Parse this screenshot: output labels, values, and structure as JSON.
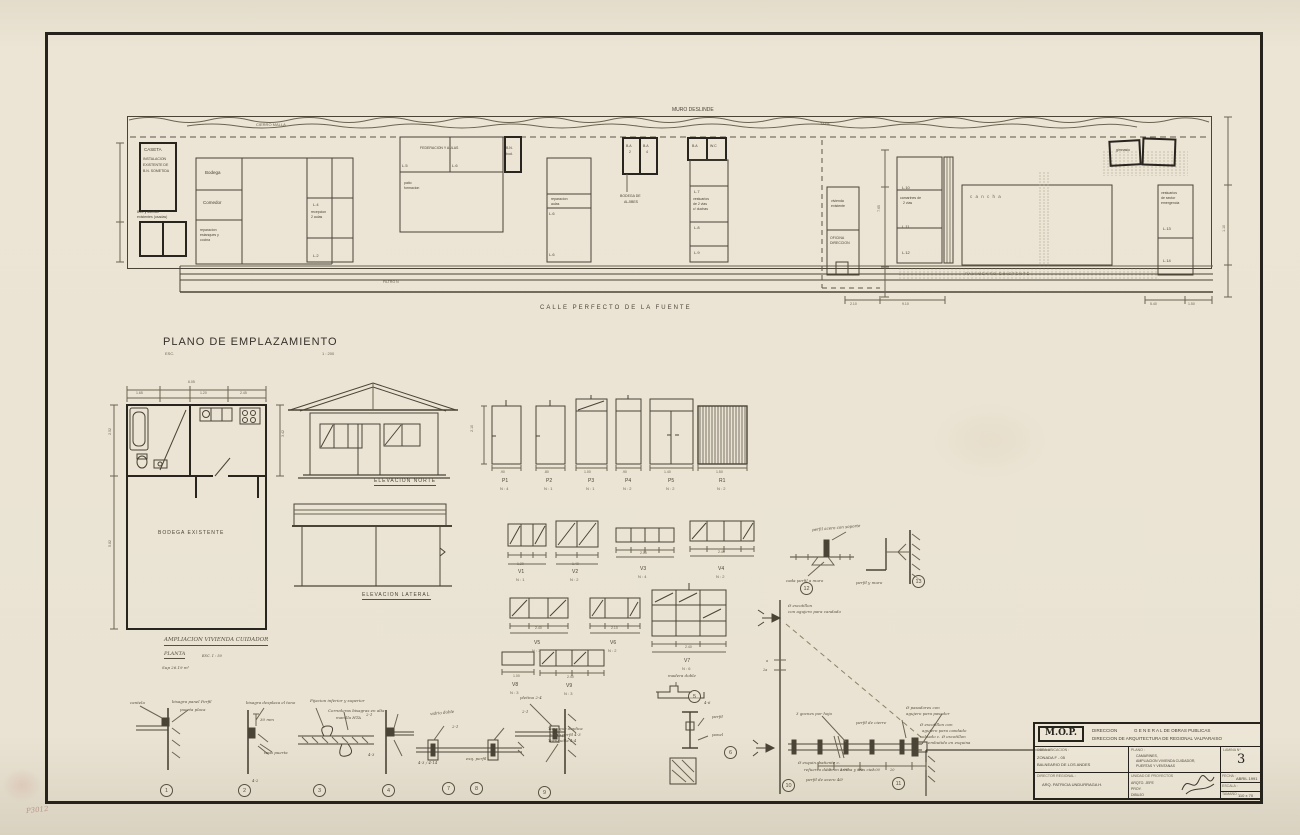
{
  "site": {
    "cierro": "CIERRO  MALLA",
    "muro": "MURO  DESLINDE",
    "tapa": "TAPA",
    "street": "CALLE   PERFECTO   DE   LA   FUENTE",
    "filtro": "FILTRO  N",
    "pavimento": "PAVIMENTO     EXISTENTE",
    "caseta_title": "CASETA",
    "caseta1": "INSTALACION",
    "caseta2": "EXISTENTE  DE",
    "caseta3": "B.N.  SOMETIDA",
    "ba1": "B.A. y duchas",
    "ba2": "existentes (usadas)",
    "bodega": "Bodega",
    "comedor": "Comedor",
    "repar1": "reparacion",
    "repar2": "estanques y",
    "repar3": "cocina",
    "recep1": "recepcion",
    "recep2": "2 aulas",
    "feder": "FEDERACION  Y  AULAS",
    "patio1": "patio",
    "patio2": "formacion",
    "bn1": "B.N.",
    "bn2": "bod.",
    "rep_aulas1": "reparacion",
    "rep_aulas2": "aulas",
    "baa1": "B.A",
    "baa2": "2",
    "bab1": "B.A",
    "bab2": "4",
    "aljibes1": "BODEGA  DE",
    "aljibes2": "ALJIBES",
    "bawc1": "B.A",
    "bawc2": "W.C",
    "vest1": "vestuarios",
    "vest2": "de 2 vias",
    "vest3": "c/ duchas",
    "viv1": "vivienda",
    "viv2": "existente",
    "ofic1": "OFICINA",
    "ofic2": "DIRECCION",
    "camar1": "camarines de",
    "camar2": "2 vias",
    "cancha": "c a n c h a",
    "gim": "gimnasio",
    "vestem1": "vestuarios",
    "vestem2": "de sector",
    "vestem3": "emergencia",
    "t2": "L.2",
    "t3": "L.3",
    "t4": "L.4",
    "t5": "L.5",
    "t6": "L.6",
    "t7": "L.7",
    "t8": "L.8",
    "t9": "L.9",
    "t10": "L.10",
    "t11": "L.11",
    "t12": "L.12",
    "t13": "L.13",
    "t14": "L.14",
    "d1": "2.10",
    "d2": "9.10",
    "d3": "5.40",
    "d4": "1.50",
    "d5": "7.65",
    "d6": "1.10"
  },
  "emplaza": {
    "title": "PLANO  DE  EMPLAZAMIENTO",
    "esc": "ESC.",
    "scale": "1 : 200"
  },
  "plan": {
    "room": "BODEGA    EXISTENTE",
    "cap1": "AMPLIACION  VIVIENDA  CUIDADOR",
    "cap2": "PLANTA",
    "cap2b": "ESC.   1 : 50",
    "cap3": "Sup   26.19  m²",
    "wtot": "6.05",
    "w1": "1.65",
    "w2": "1.20",
    "w3": "2.45",
    "h1": "2.52",
    "h2": "5.82",
    "h3": "3.42"
  },
  "elev": {
    "north": "ELEVACION   NORTE",
    "lateral": "ELEVACION   LATERAL"
  },
  "doors": {
    "height": "2.10",
    "items": [
      {
        "tag": "P1",
        "n": "N : 4",
        "w": ".90"
      },
      {
        "tag": "P2",
        "n": "N : 1",
        "w": ".80"
      },
      {
        "tag": "P3",
        "n": "N : 1",
        "w": "1.00"
      },
      {
        "tag": "P4",
        "n": "N : 2",
        "w": ".90"
      },
      {
        "tag": "P5",
        "n": "N : 2",
        "w": "1.40"
      },
      {
        "tag": "R1",
        "n": "N : 2",
        "w": "1.50"
      }
    ]
  },
  "windows": [
    {
      "tag": "V1",
      "n": "N : 1",
      "w": "1.20"
    },
    {
      "tag": "V2",
      "n": "N : 2",
      "w": "1.40"
    },
    {
      "tag": "V3",
      "n": "N : 4",
      "w": "2.00"
    },
    {
      "tag": "V4",
      "n": "N : 2",
      "w": "2.40"
    },
    {
      "tag": "V5",
      "n": "N : 3",
      "w": "2.40"
    },
    {
      "tag": "V6",
      "n": "N : 2",
      "w": "2.10"
    },
    {
      "tag": "V7",
      "n": "N : 6",
      "w": "2.40"
    },
    {
      "tag": "V8",
      "n": "N : 3",
      "w": "1.00"
    },
    {
      "tag": "V9",
      "n": "N : 3",
      "w": "2.40"
    }
  ],
  "det": {
    "c1": "1",
    "c2": "2",
    "c3": "3",
    "c4": "4",
    "c5": "5",
    "c6": "6",
    "c7": "7",
    "c8": "8",
    "c9": "9",
    "c10": "10",
    "c11": "11",
    "c12": "12",
    "c13": "13",
    "n1a": "cantela",
    "n1b": "bisagra panel  Perfil",
    "n1c": "puerta placa",
    "n2a": "bisagra desplaza el tono",
    "n2b": "30 mm",
    "n2c": "tapa puerta",
    "n2d": "4-2",
    "n3a": "Fijacion inferior y superior",
    "n3b": "Correderas bisagras en alta",
    "n3c": "manilla HTA",
    "n4a": "vidrio doble",
    "n4b": "2-1",
    "n4c": "4-3",
    "n78a": "2-1",
    "n78b": "esq. perfil",
    "n78c": "4-3 / 4-14",
    "n9a": "pletina 2-4",
    "n9b": "Tope que duplica",
    "n9c": "como perfil 4-3",
    "n9d": "Tornquilla 4-4",
    "n9e": "2-1",
    "n56a": "madera doble",
    "n56b": "4-6",
    "n56c": "perfil",
    "n56d": "panel",
    "n12a": "perfil acero con soporte",
    "n12b": "cada perfil a muro",
    "n13a": "perfil y muro",
    "g0a": "Ø escotillon",
    "g0b": "con agujero para candado",
    "g1": "3 goznes por hoja",
    "g2": "perfil de cierre",
    "g3a": "Ø pasadores con",
    "g3b": "agujero para  pasador",
    "g4a": "Ø escotillon con",
    "g4b": "agujero para candado",
    "g4c": "soldado c. Ø escotillon",
    "g4d": "embutido en esquina",
    "g5a": "Ø esquin. batiente c.",
    "g5b": "refuerzo de 8mm arriba y tras cier.",
    "g6": "perfil de acero 4Ø",
    "ga": "a",
    "gb": "2a",
    "gd1": "20",
    "gd2": "1.00",
    "gd3": "60",
    "gd4": "1.00",
    "gd5": "20"
  },
  "tb": {
    "logo": "M.O.P.",
    "dir1": "DIRECCION",
    "dir2": "G E N E R A L   DE  OBRAS  PUBLICAS",
    "dir3": "DIRECCION  DE   ARQUITECTURA  DE  REGIONAL  VALPARAISO",
    "obra_label": "OBRA  UBICACION :",
    "obra1": "ZONADA   F - 05",
    "obra2": "BALNEARIO  DE  LOS  ANDES",
    "plano_label": "PLANO :",
    "plano1": "CAMARINES,",
    "plano2": "AMPLIACION  VIVIENDA  CUIDADOR,",
    "plano3": "PUERTAS  Y  VENTANAS",
    "lamina_label": "LAMINA  Nº",
    "lamina": "3",
    "director_label": "DIRECTOR  REGIONAL :",
    "director": "ARQ.   PATRICIA   UNDURRAGA    H.",
    "unidad_label": "UNIDAD  DE  PROYECTOS",
    "u1": "ARQTO.  JEFE",
    "u2": "PROY.",
    "u3": "DIBUJO",
    "fecha_label": "FECHA :",
    "fecha": "ABRIL   1991",
    "escala_label": "ESCALA :",
    "tam_label": "TAMAÑO :",
    "tam": "110 x 70"
  },
  "corner_mark": "P3012"
}
